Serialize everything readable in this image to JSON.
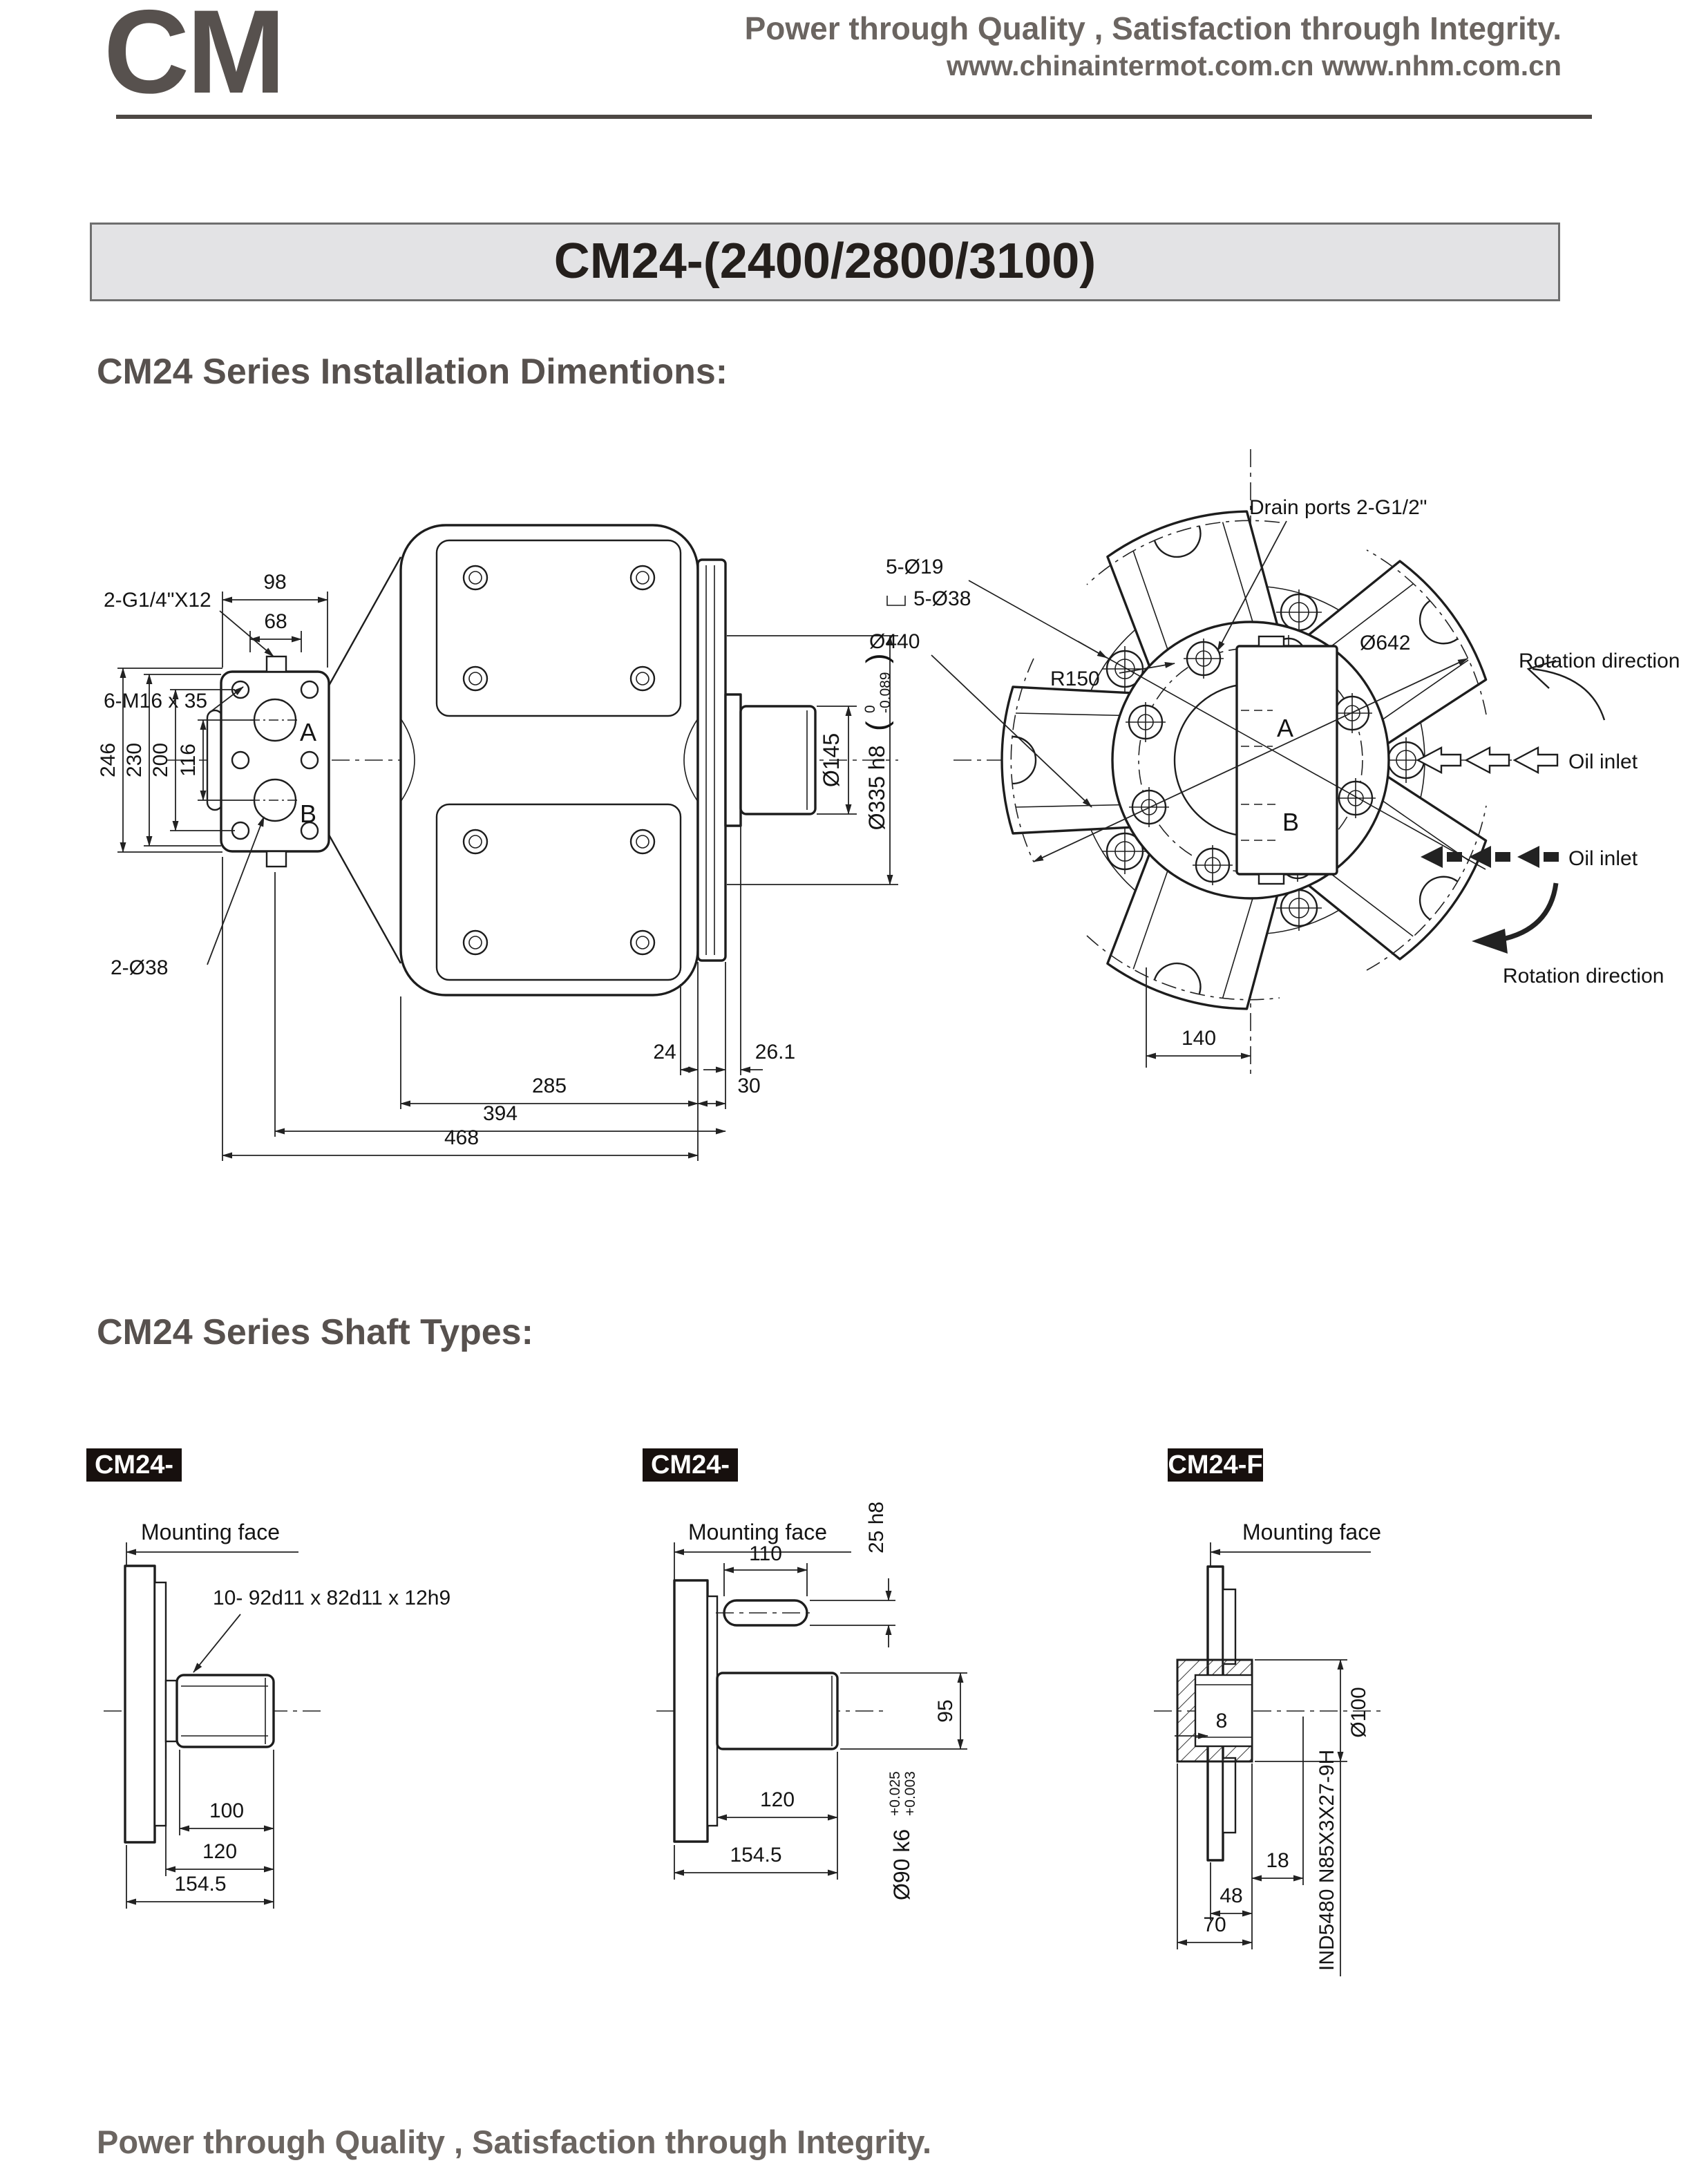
{
  "header": {
    "logo": "CM",
    "tagline": "Power through Quality , Satisfaction through Integrity.",
    "websites": "www.chinaintermot.com.cn  www.nhm.com.cn"
  },
  "title_bar": {
    "model": "CM24-(2400/2800/3100)"
  },
  "sections": {
    "installation": "CM24 Series Installation Dimentions:",
    "shaft_types": "CM24 Series Shaft Types:"
  },
  "glyphs": {
    "paren_open": "(",
    "paren_close": ")"
  },
  "installation": {
    "side_view": {
      "leaders": {
        "gauge_ports": "2-G1/4\"X12",
        "mount_bolts": "6-M16 x 35",
        "main_ports": "2-Ø38"
      },
      "ports": {
        "a": "A",
        "b": "B"
      },
      "dims": {
        "d98": "98",
        "d68": "68",
        "d246": "246",
        "d230": "230",
        "d200": "200",
        "d116": "116",
        "d24": "24",
        "d26_1": "26.1",
        "d285": "285",
        "d30": "30",
        "d394": "394",
        "d468": "468",
        "shaft_dia": "Ø145",
        "pilot_dia": "Ø335 h8",
        "pilot_tol_upper": "0",
        "pilot_tol_lower": "-0.089"
      }
    },
    "front_view": {
      "leaders": {
        "drain_ports": "Drain ports 2-G1/2\"",
        "bolt_holes": "5-Ø19",
        "counterbore": "5-Ø38",
        "flange_dia": "Ø440",
        "bolt_circle": "R150",
        "envelope_dia": "Ø642"
      },
      "ports": {
        "a": "A",
        "b": "B"
      },
      "dims": {
        "d140": "140"
      },
      "annotations": {
        "rotation_cw": "Rotation direction",
        "oil_inlet_top": "Oil inlet",
        "oil_inlet_bottom": "Oil inlet",
        "rotation_ccw": "Rotation direction"
      }
    }
  },
  "shaft_types": [
    {
      "label": "CM24-D",
      "mounting_face": "Mounting face",
      "spline": "10- 92d11 x 82d11 x 12h9",
      "dims": {
        "d100": "100",
        "d120": "120",
        "d154_5": "154.5"
      }
    },
    {
      "label": "CM24-P",
      "mounting_face": "Mounting face",
      "dims": {
        "d110": "110",
        "key": "25 h8",
        "d95": "95",
        "d120": "120",
        "d154_5": "154.5",
        "shaft_dia": "Ø90 k6",
        "tol_upper": "+0.025",
        "tol_lower": "+0.003"
      }
    },
    {
      "label": "CM24-F",
      "mounting_face": "Mounting face",
      "spline": "IND5480 N85X3X27-9H",
      "dims": {
        "d8": "8",
        "bore_dia": "Ø100",
        "d18": "18",
        "d48": "48",
        "d70": "70"
      }
    }
  ],
  "footer": {
    "tagline": "Power through Quality , Satisfaction through Integrity."
  }
}
